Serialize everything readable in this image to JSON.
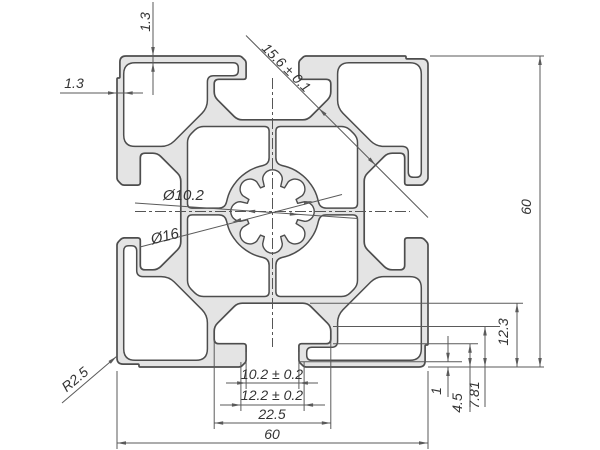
{
  "drawing": {
    "colors": {
      "background": "#ffffff",
      "profile_fill": "#e4e4e4",
      "profile_stroke": "#4d4d4d",
      "dimension_line": "#5a5a5a",
      "text": "#333333"
    },
    "labels": {
      "top_wall_thickness": "1.3",
      "left_wall_thickness": "1.3",
      "slot_diagonal": "15.6 ± 0.1",
      "bore_diameter_small": "Ø10.2",
      "bore_diameter_large": "Ø16",
      "height": "60",
      "corner_radius": "R2.5",
      "slot_opening": "10.2 ± 0.2",
      "slot_opening_outer": "12.2 ± 0.2",
      "slot_cavity_width": "22.5",
      "width": "60",
      "lip_chamfer_depth": "1",
      "lip_depth": "4.5",
      "chamfer_start_depth": "7.81",
      "cavity_depth": "12.3"
    }
  }
}
